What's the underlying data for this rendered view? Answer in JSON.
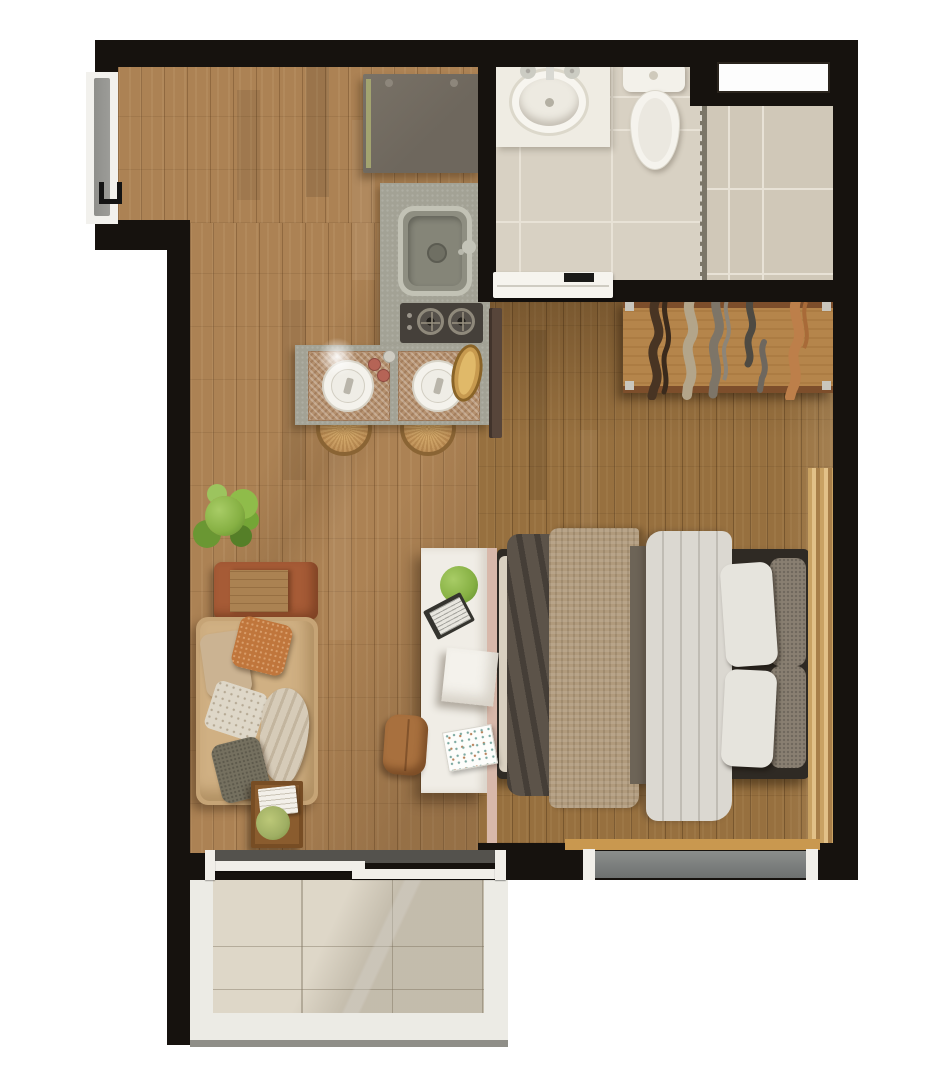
{
  "meta": {
    "description": "Top-down 3D rendered floor plan of a studio apartment with entry, kitchen, bathroom with shower, combined living and sleeping area, and balcony",
    "view": "top-down",
    "canvas": {
      "width_px": 949,
      "height_px": 1080
    }
  },
  "palette": {
    "bg": "#ffffff",
    "wall": "#16120e",
    "floor_living": "#ac8254",
    "floor_bedroom": "#97703f",
    "tile_bath": "#d8d1c3",
    "tile_grout": "#e8e2d6",
    "tile_shower": "#d0c8b8",
    "tile_balcony": "#ded7c8",
    "parapet": "#ecebe5",
    "glass": "#54524d",
    "glass_frame": "#7b7668",
    "door_gray": "#9c9c98",
    "window_gray": "#6e7170",
    "ledge_wood": "#c9984f",
    "vanity": "#efece3",
    "counter": "#a3a295",
    "stove": "#45403a",
    "fridge": "#6e675d",
    "fridge_accent": "#a3a470",
    "stool_rattan": "#c1945c",
    "stool_rim": "#8a6434",
    "placemat": "#b5916f",
    "tray_wood": "#c79a4f",
    "shaker_red": "#b56456",
    "board_dark": "#57453a",
    "bench_wood": "#b5854b",
    "bench_rail": "#7d4e2b",
    "bed_frame": "#2f2a24",
    "sheet": "#d9d0c0",
    "blanket_dark": "#5c5349",
    "blanket_tan": "#b09a7c",
    "blanket_gray": "#6d6457",
    "duvet": "#dbd8d1",
    "bedpillow_white": "#e6e4dd",
    "bedpillow_gray": "#897f71",
    "curtain": "#c9a263",
    "curtain_light": "#e2c188",
    "curtain_dark": "#a87f49",
    "sofa": "#c6a476",
    "sofa_light": "#d0b083",
    "headrest": "#a65b36",
    "wood_mid": "#ab8252",
    "pillow_orange": "#c0763c",
    "pillow_beige": "#cbb392",
    "pillow_white": "#ded7c8",
    "pillow_gray": "#75705f",
    "throw_cream": "#d6cbb8",
    "table_wood": "#774d24",
    "pouf": "#a8703e",
    "desk_white": "#f0ede6",
    "desk_edge_pink": "#d8b8aa",
    "plant_green": "#86b043",
    "plant_green_light": "#a8cc66",
    "plant_green_dark": "#5d8a2c",
    "cloth_brown": "#483423",
    "cloth_beige": "#b3a58a",
    "cloth_gray": "#7d7568",
    "cloth_darkgray": "#4e4a42",
    "cloth_orange": "#bd7f4a"
  },
  "scene": {
    "rooms": [
      {
        "name": "entry"
      },
      {
        "name": "kitchen"
      },
      {
        "name": "bathroom"
      },
      {
        "name": "shower"
      },
      {
        "name": "living-area"
      },
      {
        "name": "sleeping-area"
      },
      {
        "name": "balcony"
      }
    ],
    "furniture": {
      "entry": [
        "entry-door",
        "entry-cabinet"
      ],
      "kitchen": [
        "kitchen-counter",
        "kitchen-sink",
        "two-burner-cooktop",
        "dining-counter",
        "two-placemats-with-plates",
        "two-rattan-stools",
        "serving-tray",
        "condiment-shakers"
      ],
      "bathroom": [
        "vanity-with-oval-sink",
        "toilet",
        "sliding-door",
        "glass-shower-partition",
        "transom-window"
      ],
      "sleeping-area": [
        "double-bed-with-pillows-and-blankets",
        "clothes-rack-bench-with-hanging-garments",
        "curtain",
        "window-with-wood-sill"
      ],
      "living-area": [
        "sofa-daybed-with-throw-pillows",
        "leather-headrest",
        "large-potted-plant",
        "side-table-with-book-and-plant",
        "ottoman-pouf",
        "white-desk-with-plant-notebook-box-magazine"
      ],
      "balcony": [
        "sliding-glass-door",
        "tiled-floor",
        "white-parapet"
      ]
    }
  }
}
